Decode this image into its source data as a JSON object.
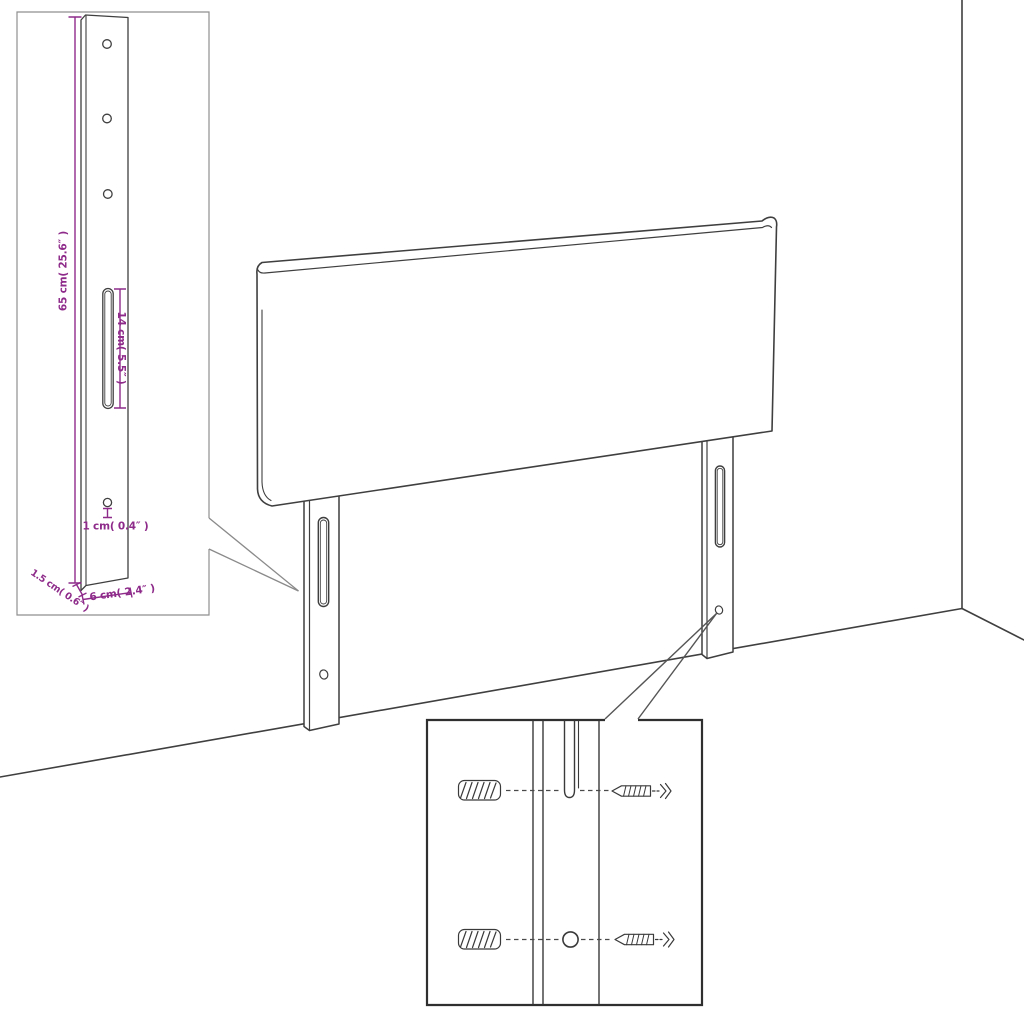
{
  "diagram": {
    "kind": "headboard dimension and wall-mounting diagram",
    "colors": {
      "background": "#ffffff",
      "line_art": "#3f3f3f",
      "dimension_accent": "#8E2B8A",
      "panel_border_light": "#8f8f8f",
      "panel_border_dark": "#2f2f2f"
    },
    "leg_detail_panel": {
      "dim_height": "65 cm( 25.6″ )",
      "dim_slot_length": "14 cm( 5.5″ )",
      "dim_hole_diameter": "1 cm( 0.4″ )",
      "dim_thickness": "1.5 cm( 0.6″ )",
      "dim_width": "6 cm( 2.4″ )",
      "hole_count": 3
    },
    "main_view": {
      "object": "headboard",
      "leg_count": 2
    },
    "mounting_detail_panel": {
      "hardware": [
        "wall-plug",
        "screw"
      ],
      "row_count": 2
    }
  }
}
